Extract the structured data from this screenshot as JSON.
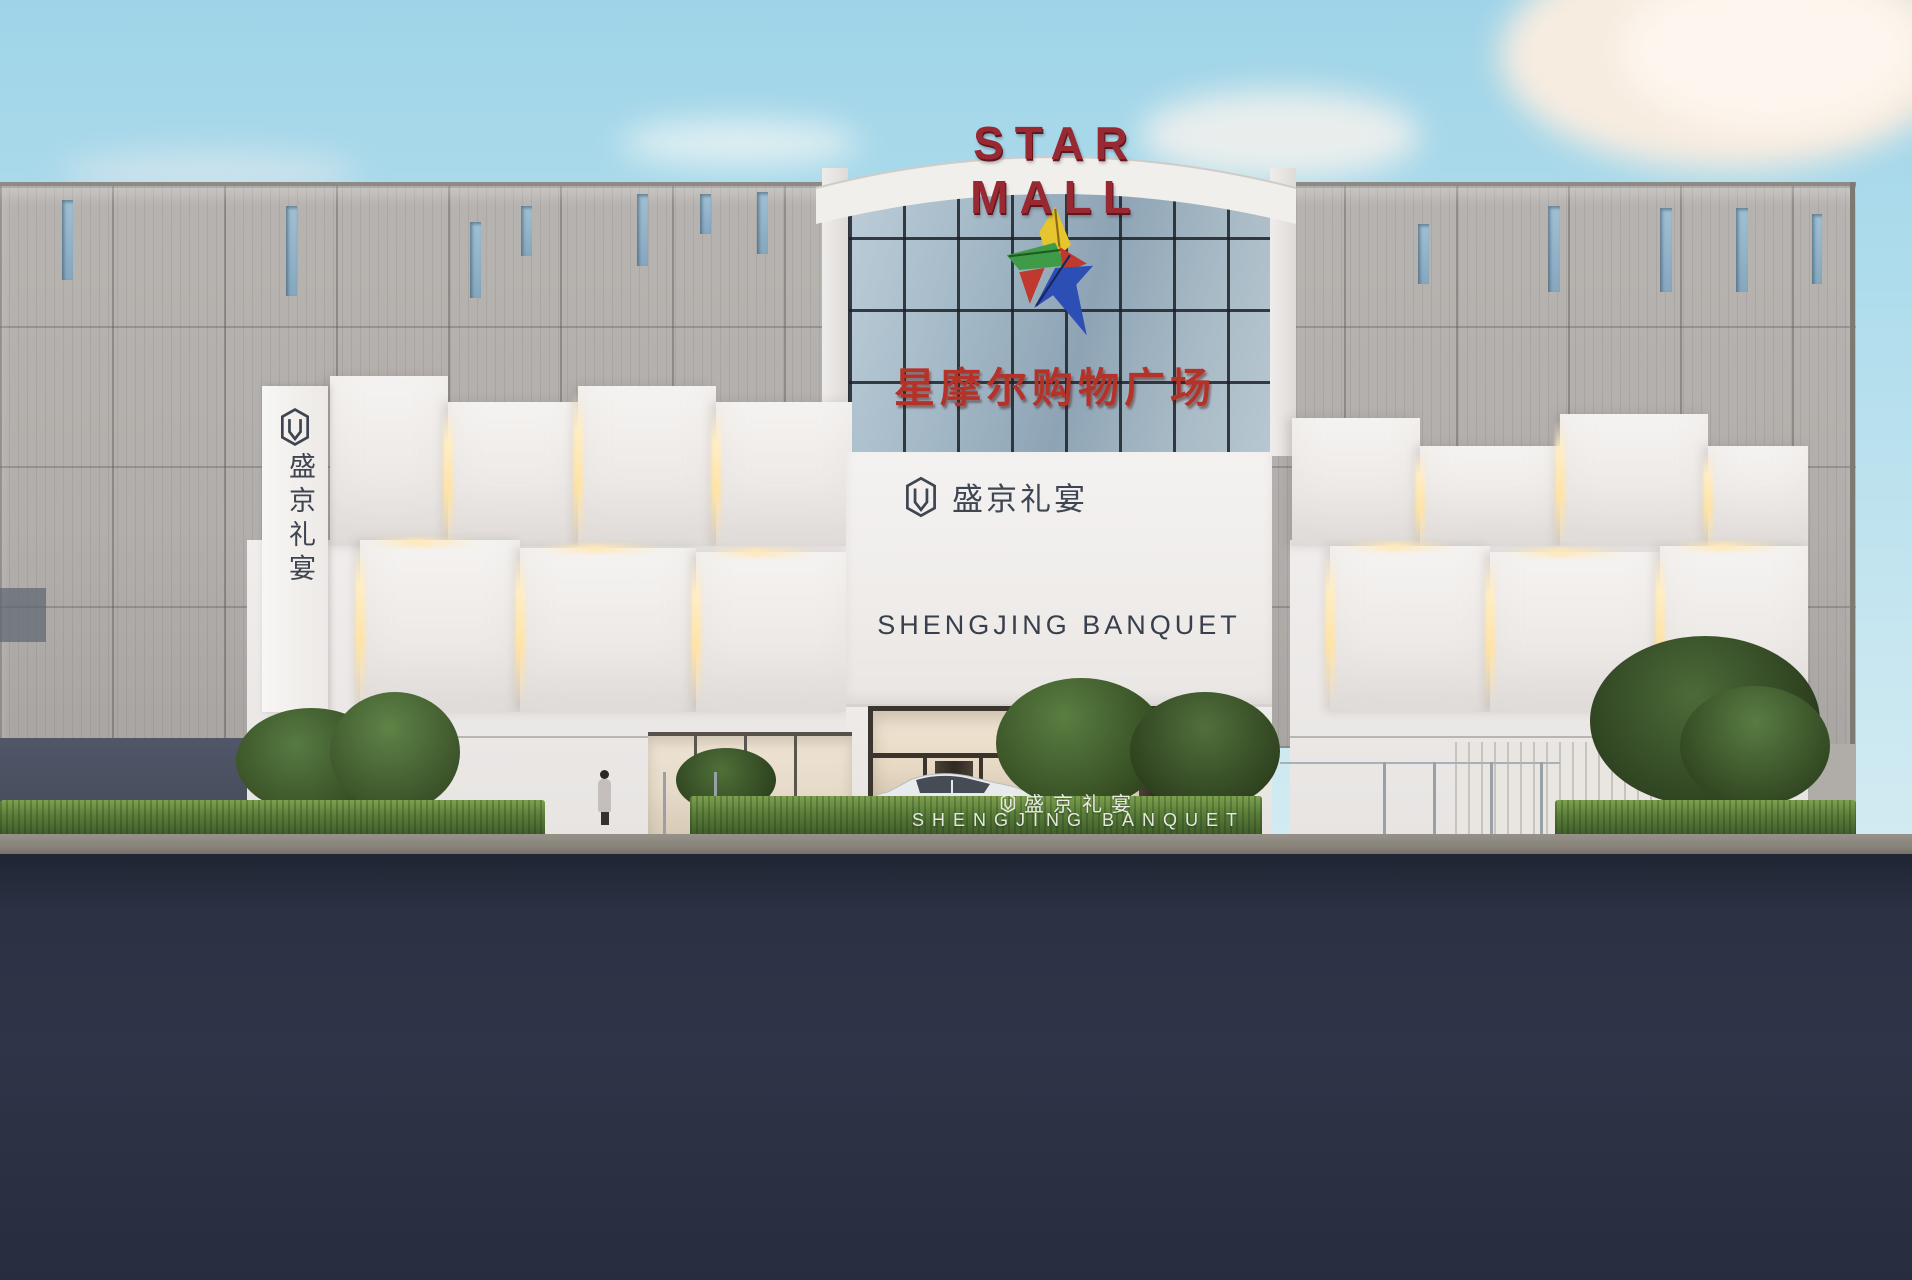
{
  "scene": {
    "type": "architectural-rendering",
    "description": "Daytime exterior rendering of Star Mall shopping plaza facade with central glass tower, sculpted white banquet-hall entrance, hedges, trees, pedestrians and a parked white sedan"
  },
  "signs": {
    "mall_name_en": "STAR MALL",
    "mall_name_cn": "星摩尔购物广场",
    "banquet_name_cn": "盛京礼宴",
    "banquet_name_en": "SHENGJING BANQUET",
    "vertical_sign_cn": "盛京礼宴",
    "hedge_sign_cn": "盛京礼宴",
    "hedge_sign_en": "SHENGJING BANQUET"
  },
  "palette": {
    "star_mall_red": "#982832",
    "mall_cn_red": "#b43228",
    "banquet_text_gray": "#3e4652",
    "sky_blue": "#aedcec",
    "facade_gray": "#b2aeab",
    "panel_white": "#f0edec",
    "cove_light_warm": "#ffe3a6",
    "hedge_green": "#5b7f3a",
    "road_navy": "#2b3244",
    "star_logo_yellow": "#e6c52e",
    "star_logo_green": "#3f9b48",
    "star_logo_red": "#c0392e",
    "star_logo_blue": "#2d4fb5"
  }
}
